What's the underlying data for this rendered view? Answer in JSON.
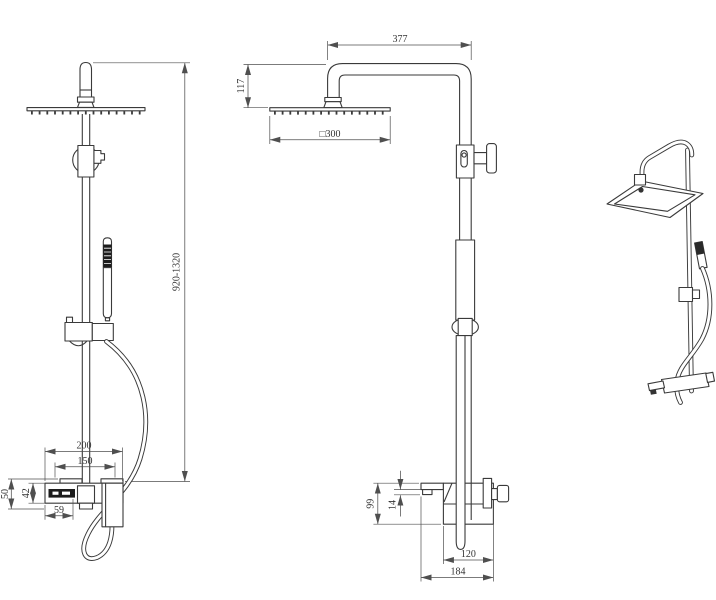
{
  "colors": {
    "background": "#ffffff",
    "line": "#3a3a3a",
    "dimension_line": "#4f4f4f",
    "dimension_text": "#333333",
    "dark_fill": "#1c1c1c"
  },
  "views": {
    "side": {
      "dims": {
        "height_range": "920-1320",
        "width_total": "200",
        "width_inner": "150",
        "height_outer": "50",
        "height_body": "42",
        "spout_offset": "59"
      }
    },
    "front": {
      "dims": {
        "arm_reach": "377",
        "head_drop": "117",
        "head_size": "□300",
        "mixer_height": "99",
        "spout_gap": "14",
        "body_width": "120",
        "total_width": "184"
      }
    },
    "perspective": {}
  }
}
